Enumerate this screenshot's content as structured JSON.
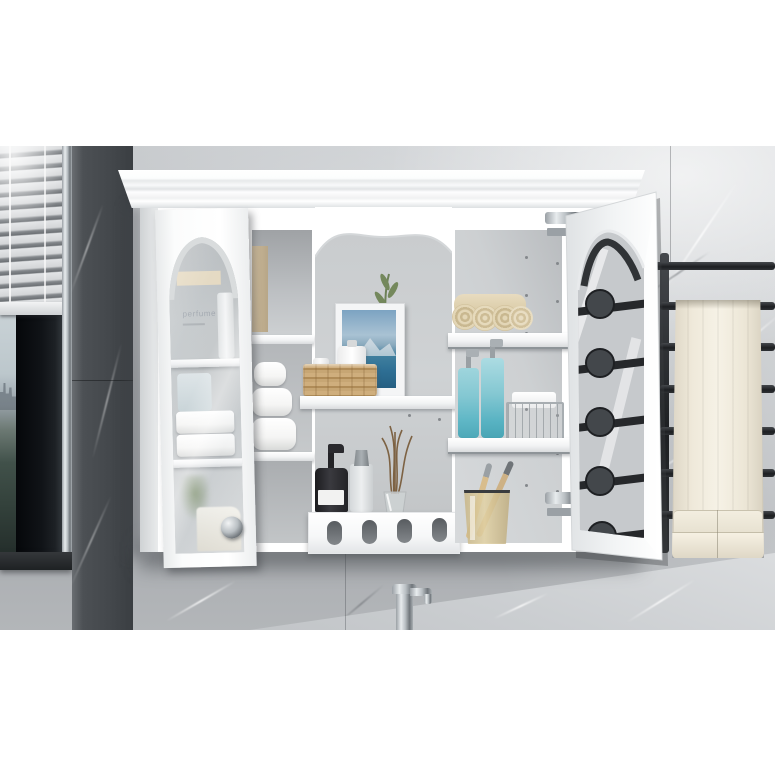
{
  "scene": {
    "title": "White wall-mounted bathroom medicine cabinet with glass doors",
    "setting": "gray marble bathroom wall with venetian-blind window, black ladder towel radiator and chrome faucet",
    "labels": {
      "perfume_box": "perfume"
    },
    "colors": {
      "cabinet_white": "#ffffff",
      "wall_marble_light": "#c3c6c9",
      "wall_marble_dark": "#4b4f53",
      "towel_rack_black": "#232527",
      "hanging_towel_ivory": "#f0ebe0",
      "teal_bottle": "#7fc9d4",
      "beige_towel": "#ddcfae",
      "rattan_basket": "#c2a070",
      "black_bottle": "#2a2a2d",
      "chrome": "#b9bec2",
      "artwork_blue": "#4a7fa8",
      "olive_green": "#6d8157",
      "amber_glass": "#d6c08e"
    },
    "objects": [
      {
        "name": "white wall cabinet"
      },
      {
        "name": "venetian blinds"
      },
      {
        "name": "window with city view"
      },
      {
        "name": "dark marble pillar"
      },
      {
        "name": "crown molding"
      },
      {
        "name": "left glass door (ajar)"
      },
      {
        "name": "perfume box"
      },
      {
        "name": "folded white towels"
      },
      {
        "name": "rolled white towels"
      },
      {
        "name": "framed coastal artwork"
      },
      {
        "name": "olive branch in vase"
      },
      {
        "name": "woven rattan basket"
      },
      {
        "name": "white lotion bottle"
      },
      {
        "name": "black soap dispenser"
      },
      {
        "name": "frosted spray bottle"
      },
      {
        "name": "reed diffuser"
      },
      {
        "name": "drawer with oval cutouts"
      },
      {
        "name": "rolled beige towels"
      },
      {
        "name": "teal soap dispensers"
      },
      {
        "name": "wire storage basket"
      },
      {
        "name": "toothbrush glass with wooden toothbrushes"
      },
      {
        "name": "open right glass door"
      },
      {
        "name": "black towel radiator"
      },
      {
        "name": "ivory bath towel"
      },
      {
        "name": "chrome faucet"
      },
      {
        "name": "chrome door knob"
      },
      {
        "name": "chrome door hinge"
      }
    ]
  }
}
